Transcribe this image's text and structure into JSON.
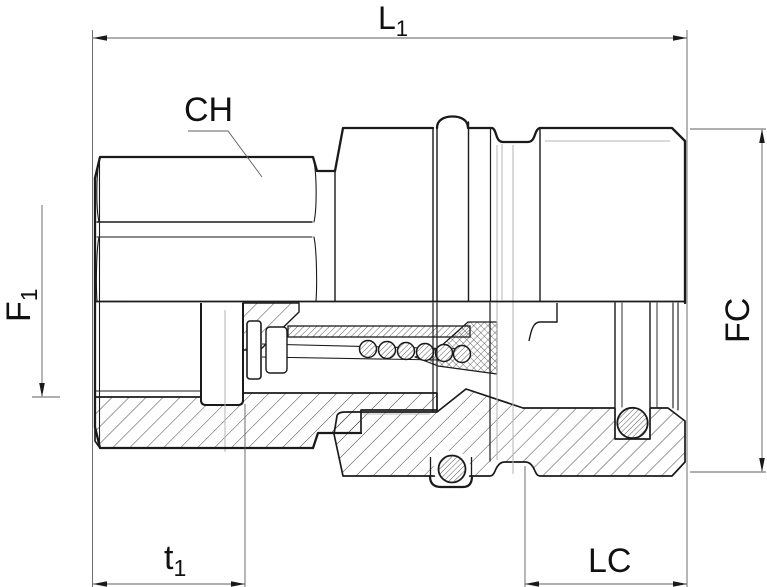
{
  "drawing": {
    "type": "technical-cross-section",
    "subject": "hydraulic quick-release coupling, female half, half-section view",
    "labels": {
      "overall_length": {
        "main": "L",
        "sub": "1"
      },
      "hex_across_flats": "CH",
      "thread_size": {
        "main": "F",
        "sub": "1"
      },
      "coupler_diameter": "FC",
      "thread_depth": {
        "main": "t",
        "sub": "1"
      },
      "coupler_length": "LC"
    },
    "colors": {
      "outline": "#1a1a1a",
      "hatch": "#2f2f2f",
      "dimension_line": "#5f5f5f",
      "tangent_line": "#b4b4b4",
      "background": "#ffffff"
    }
  }
}
